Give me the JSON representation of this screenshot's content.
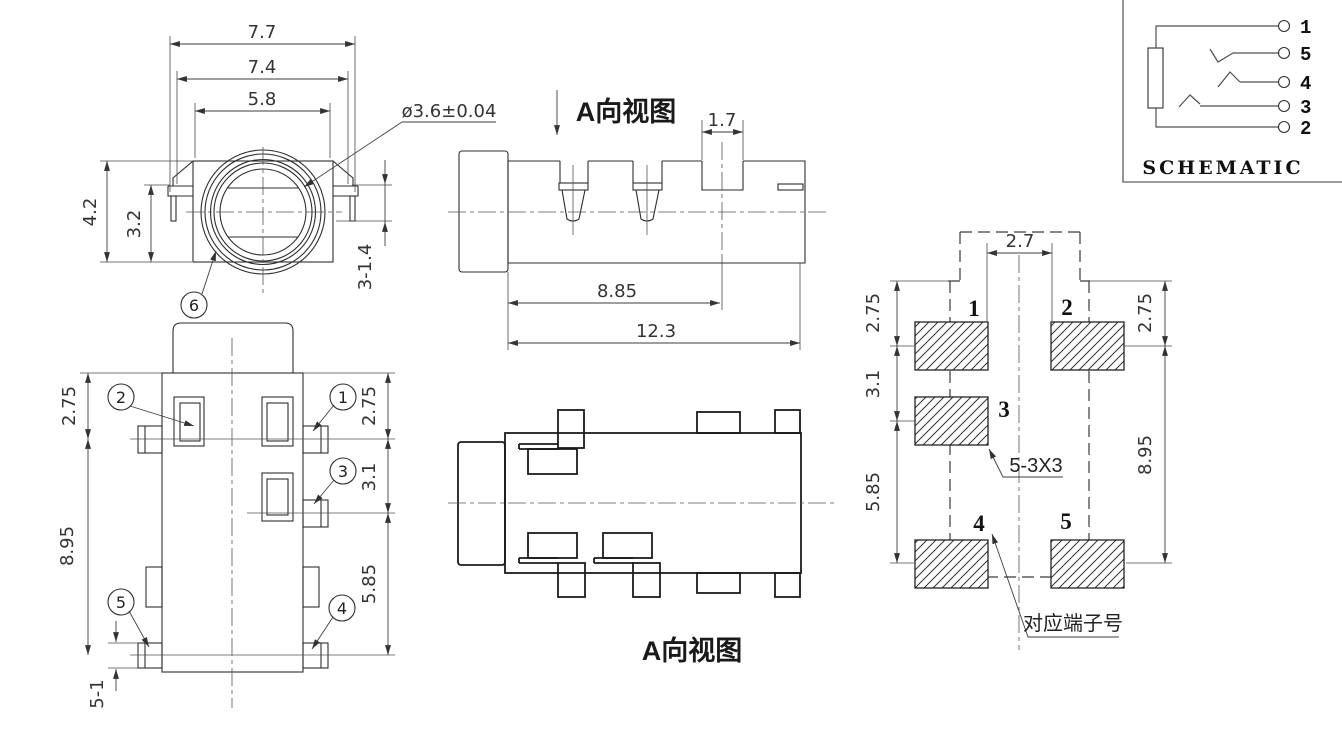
{
  "drawing": {
    "front_view": {
      "dim_77": "7.7",
      "dim_74": "7.4",
      "dim_58": "5.8",
      "dim_dia": "ø3.6±0.04",
      "dim_42": "4.2",
      "dim_32": "3.2",
      "dim_314": "3-1.4",
      "callout_6": "6"
    },
    "bottom_view": {
      "dim_275_left": "2.75",
      "dim_895": "8.95",
      "dim_51": "5-1",
      "dim_275_right": "2.75",
      "dim_31": "3.1",
      "dim_585": "5.85",
      "callout_1": "1",
      "callout_2": "2",
      "callout_3": "3",
      "callout_4": "4",
      "callout_5": "5"
    },
    "side_view": {
      "label": "A向视图",
      "dim_17": "1.7",
      "dim_885": "8.85",
      "dim_123": "12.3"
    },
    "a_view": {
      "label": "A向视图"
    },
    "land_pattern": {
      "dim_27": "2.7",
      "dim_275_left": "2.75",
      "dim_31": "3.1",
      "dim_585": "5.85",
      "dim_275_right": "2.75",
      "dim_895": "8.95",
      "pad_1": "1",
      "pad_2": "2",
      "pad_3": "3",
      "pad_4": "4",
      "pad_5": "5",
      "note_pad_size": "5-3X3",
      "note_terminal": "对应端子号"
    },
    "schematic": {
      "title": "SCHEMATIC",
      "pin_1": "1",
      "pin_5": "5",
      "pin_4": "4",
      "pin_3": "3",
      "pin_2": "2"
    },
    "colors": {
      "line": "#2e2e2e",
      "bold_line": "#1b1b1b",
      "background": "#ffffff"
    }
  }
}
